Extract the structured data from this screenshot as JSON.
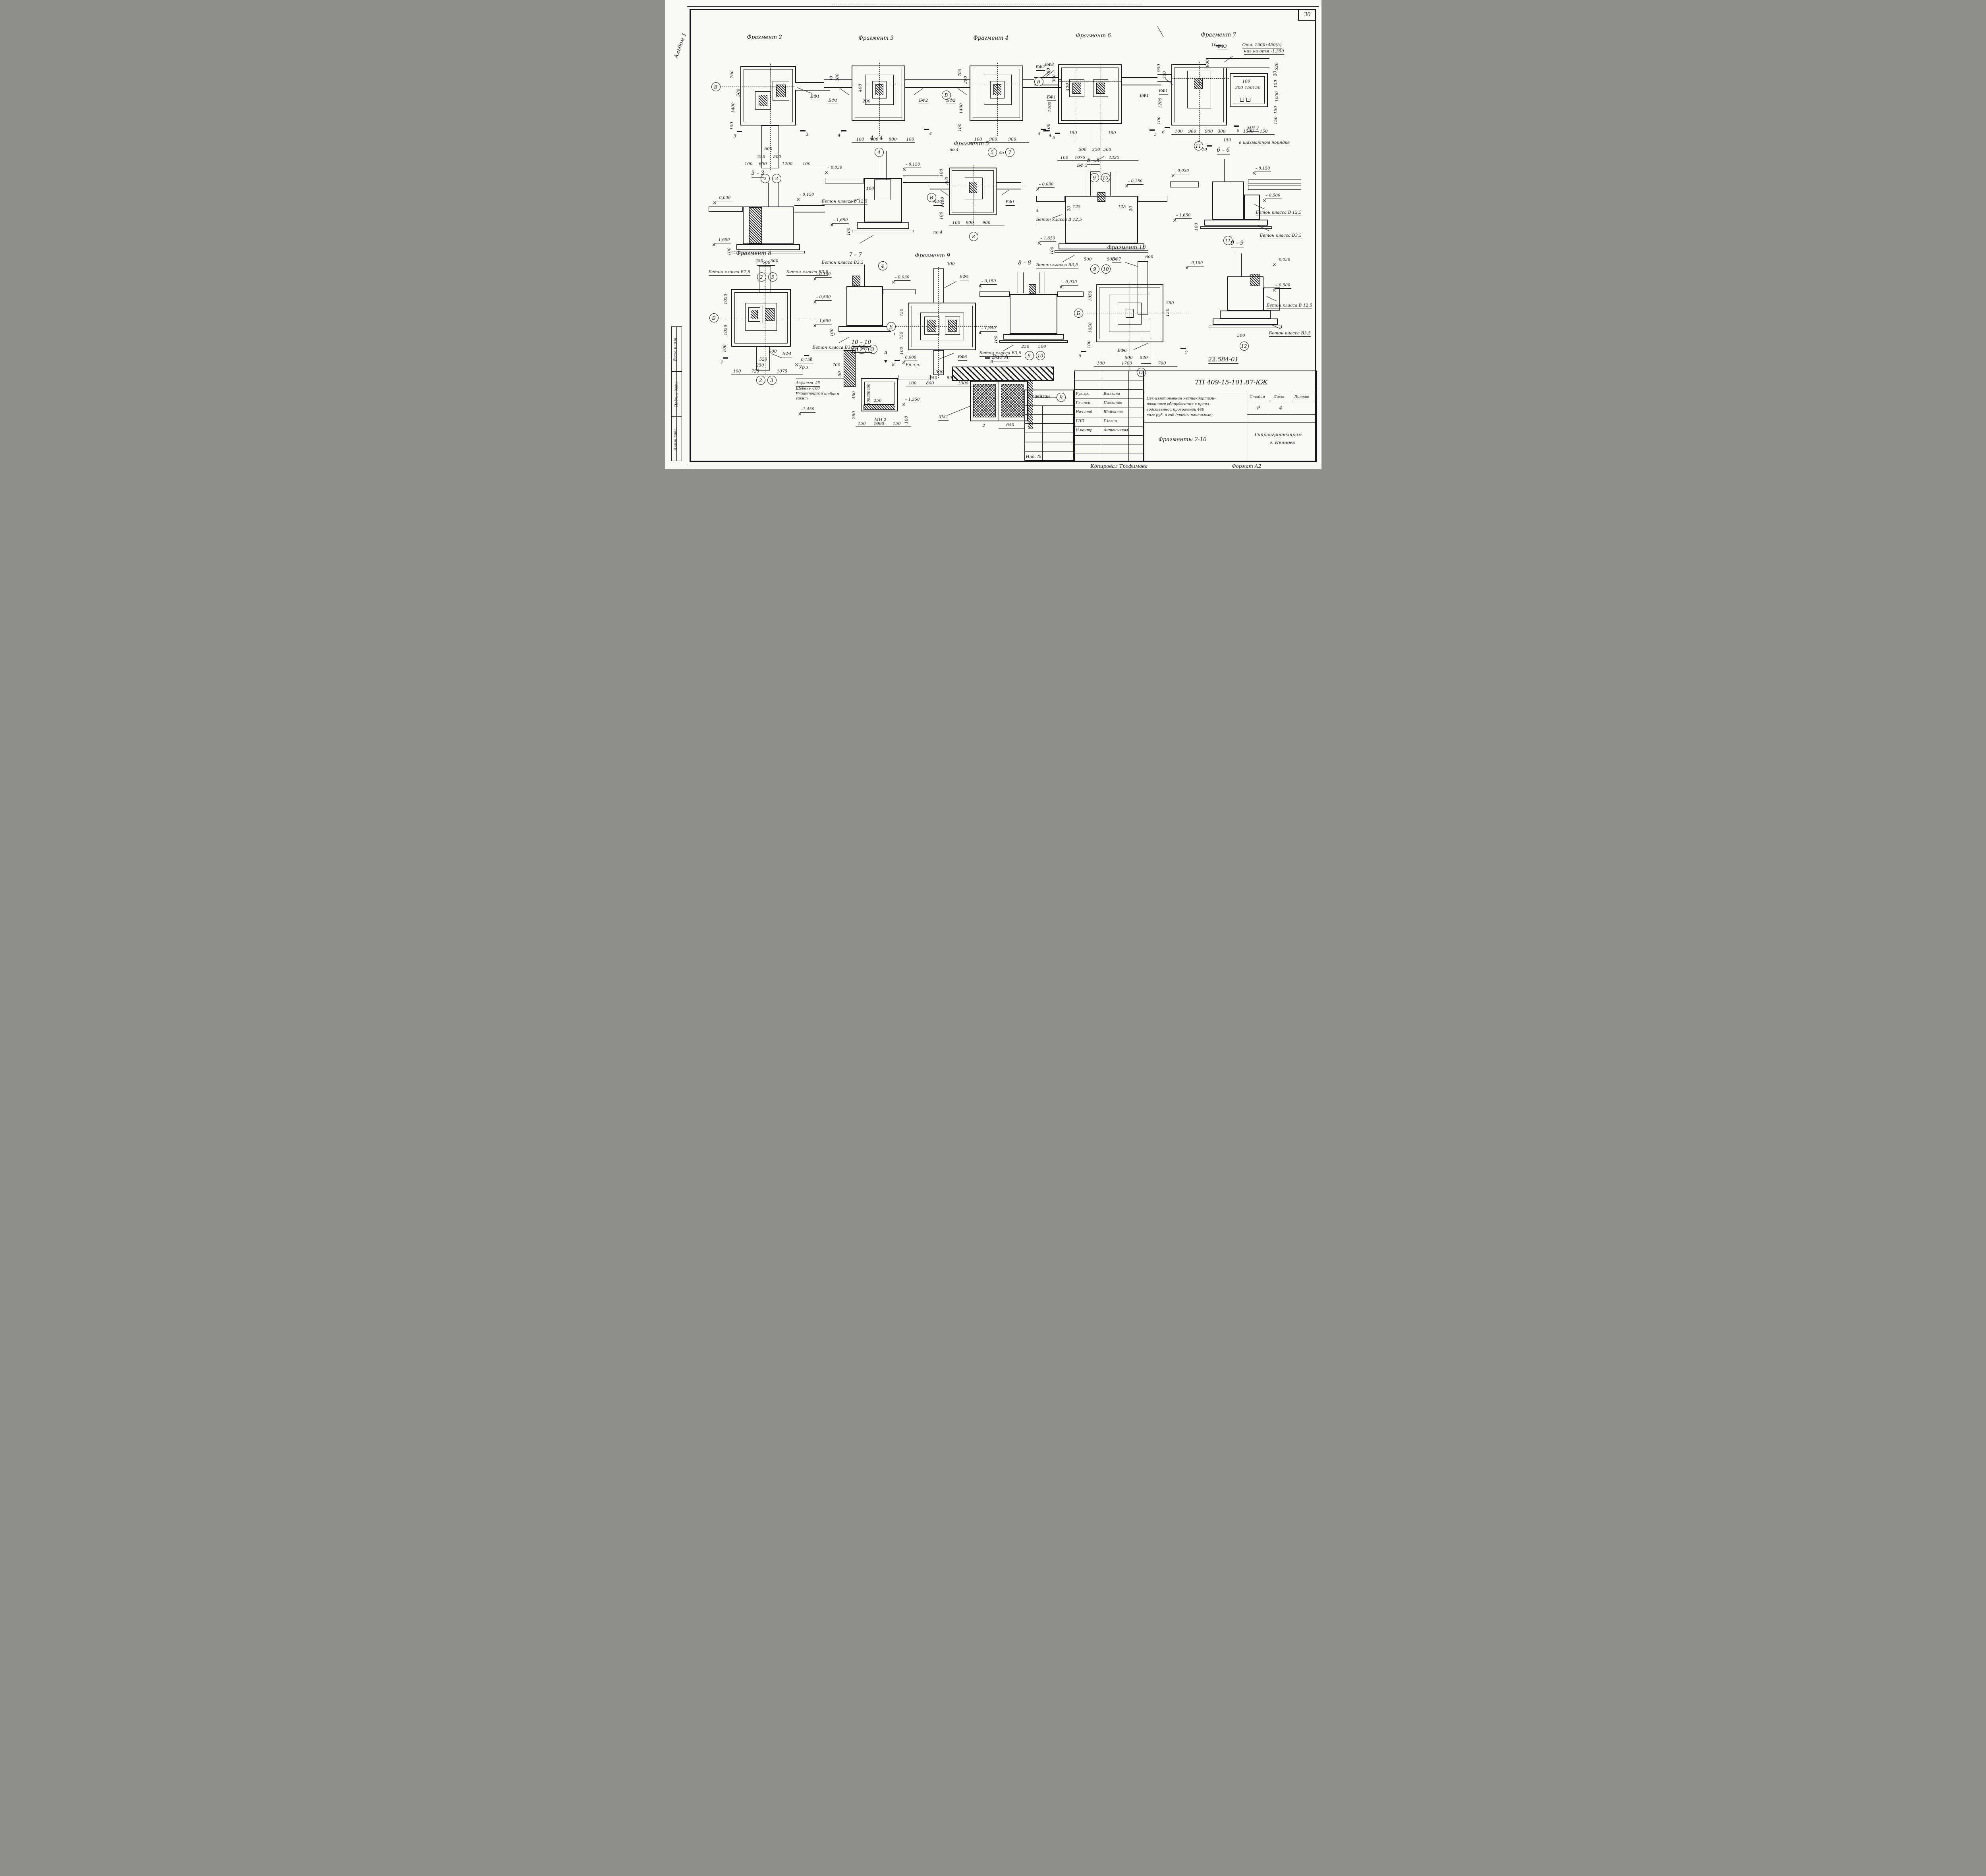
{
  "page": {
    "sheet_number": "30",
    "album_label": "Альбом 1",
    "side_stamp": [
      "Взам. инв.№",
      "Подп. и дата",
      "Инв.№ подл."
    ],
    "doc_number_note": "22.584-01",
    "copied_by": "Копировал Трофимова",
    "format_label": "Формат А2"
  },
  "title_block": {
    "type_code": "ТП 409-15-101.87-КЖ",
    "attached_label": "Привязан",
    "inv_label": "Инв. №",
    "signatures": [
      {
        "role": "Рук.гр.",
        "name": "Вылгина"
      },
      {
        "role": "Гл.спец",
        "name": "Павлинов"
      },
      {
        "role": "Нач.отд.",
        "name": "Шайхалов"
      },
      {
        "role": "ГИП",
        "name": "Глезин"
      },
      {
        "role": "Н.контр.",
        "name": "Антонычева"
      }
    ],
    "project_lines": [
      "Цех изготовления нестандартизи-",
      "рованного оборудования с произ-",
      "водственной программой 440",
      "тыс.руб. в год (стены панельные)"
    ],
    "stage_label": "Стадия",
    "sheet_label": "Лист",
    "sheets_label": "Листов",
    "stage_value": "Р",
    "sheet_value": "4",
    "sheet_title": "Фрагменты 2-10",
    "organization": "Гипроагротехпром",
    "organization_city": "г. Иваново"
  },
  "drawings": {
    "frag2": {
      "title": "Фрагмент 2",
      "grid_row": "В",
      "grid_col_1": "2",
      "grid_col_2": "3",
      "element_1": "БФ1",
      "cut": "3",
      "dim_l1": "700",
      "dim_l2": "500",
      "dim_l3": "1400",
      "dim_l4": "100",
      "dim_r1": "300",
      "dim_b1": "600",
      "dim_b2": "250",
      "dim_b3": "500",
      "dim_b4": "100",
      "dim_b5": "600",
      "dim_b6": "1200",
      "dim_b7": "100"
    },
    "frag3": {
      "title": "Фрагмент 3",
      "grid_row": "В",
      "grid_col_1": "4",
      "element_1": "БФ1",
      "element_2": "БФ2",
      "cut": "4",
      "dim_1": "300",
      "dim_2": "400",
      "dim_3": "200",
      "dim_b1": "100",
      "dim_b2": "900",
      "dim_b3": "900",
      "dim_b4": "100"
    },
    "frag4": {
      "title": "Фрагмент 4",
      "grid_row": "В",
      "grid_col_1": "5",
      "grid_between": "до",
      "grid_col_2": "7",
      "element_1": "БФ2",
      "element_2": "БФ2",
      "cut_left": "по 4",
      "cut_right": "4",
      "dim_l1": "700",
      "dim_l2": "300",
      "dim_l3": "1400",
      "dim_l4": "100",
      "dim_b1": "100",
      "dim_b2": "900",
      "dim_b3": "900"
    },
    "frag6": {
      "title": "Фрагмент 6",
      "grid_row": "В",
      "grid_col_1": "9",
      "grid_col_2": "10",
      "element_1": "БФ2",
      "element_2": "БФ1",
      "element_3": "БФ1",
      "element_4": "БФ 5",
      "cut_1": "4",
      "cut_2": "5",
      "cut_3": "5",
      "dim_l1": "700",
      "dim_l2": "300",
      "dim_l3": "1400",
      "dim_l4": "100",
      "dim_i1": "400",
      "dim_i2": "150",
      "dim_i3": "150",
      "dim_m1": "500",
      "dim_m2": "250",
      "dim_m3": "500",
      "dim_b1": "100",
      "dim_b2": "1075",
      "dim_b3": "1325"
    },
    "frag7": {
      "title": "Фрагмент 7",
      "grid_col_1": "11",
      "cut_top": "10",
      "cut_bottom": "10",
      "cut_left": "6",
      "cut_mid": "6",
      "element_1": "БФ3",
      "element_2": "БФ1",
      "note_hole_1": "Отв. 1500х450(h)",
      "note_hole_2": "низ на отм.-1,350",
      "note_mn_1": "МН 2",
      "note_mn_2": "в шахматном порядке",
      "dim_l1": "900",
      "dim_l2": "300",
      "dim_l3": "1200",
      "dim_l4": "100",
      "dim_top": "600",
      "dim_r1": "520",
      "dim_r2": "20",
      "dim_r3": "150",
      "dim_r4": "1000",
      "dim_r5": "150",
      "dim_r6": "150",
      "dim_i1": "100",
      "dim_i2": "300",
      "dim_i3": "150",
      "dim_i4": "150",
      "dim_b1": "100",
      "dim_b2": "900",
      "dim_b3": "900",
      "dim_b4": "300",
      "dim_b5": "150",
      "dim_b6": "1500",
      "dim_b7": "150"
    },
    "s33": {
      "title": "3 – 3",
      "elev_1": "– 0,030",
      "elev_2": "– 0,150",
      "elev_3": "– 1,650",
      "dim_v": "100",
      "dim_b1": "250",
      "dim_b2": "500",
      "mat_1": "Бетон класса В7,5",
      "mat_2": "Бетон класса В3,5",
      "grid_col_1": "2",
      "grid_col_2": "3"
    },
    "s44": {
      "title": "4 – 4",
      "elev_1": "– 0,030",
      "elev_2": "– 0,150",
      "elev_3": "– 1,650",
      "dim_1": "100",
      "dim_v": "100",
      "mat_1": "Бетон класса В 12,5",
      "mat_2": "Бетон класса В3,5",
      "grid_col_1": "4"
    },
    "frag5": {
      "title": "Фрагмент 5",
      "grid_row": "В",
      "grid_col_1": "8",
      "element_1": "БФ2",
      "element_2": "БФ1",
      "cut_left": "по 4",
      "dim_l1": "100",
      "dim_l2": "300",
      "dim_l3": "1400",
      "dim_l4": "100",
      "dim_b1": "100",
      "dim_b2": "900",
      "dim_b3": "900"
    },
    "s55": {
      "title": "5 – 5",
      "elev_1": "– 0,030",
      "elev_2": "– 0,150",
      "elev_3": "– 1,650",
      "cut": "4",
      "dim_1": "20",
      "dim_2": "125",
      "dim_3": "125",
      "dim_4": "20",
      "dim_v": "100",
      "mat_1": "Бетон класса В 12,5",
      "mat_2": "Бетон класса В3,5",
      "dim_b1": "500",
      "dim_b2": "500",
      "grid_col_1": "9",
      "grid_col_2": "10"
    },
    "s66": {
      "title": "6 – 6",
      "elev_1": "– 0,030",
      "elev_2": "– 0,150",
      "elev_3": "– 0,500",
      "elev_4": "– 1,650",
      "dim_v": "100",
      "mat_1": "Бетон класса В 12,5",
      "mat_2": "Бетон класса В3,5",
      "grid_col_1": "11"
    },
    "frag8": {
      "title": "Фрагмент 8",
      "grid_row": "Б",
      "grid_col_1": "2",
      "grid_col_2": "3",
      "element_1": "БФ4",
      "cut": "7",
      "dim_top": "600",
      "dim_l1": "1050",
      "dim_l2": "1050",
      "dim_l3": "100",
      "dim_m1": "600",
      "dim_m2": "520",
      "dim_m3": "250",
      "dim_b1": "100",
      "dim_b2": "725",
      "dim_b3": "1075"
    },
    "s77": {
      "title": "7 – 7",
      "elev_1": "– 0,150",
      "elev_2": "– 0,030",
      "elev_3": "– 0,500",
      "elev_4": "– 1,650",
      "dim_v": "100",
      "mat_1": "Бетон класса В3,5",
      "grid_col_1": "2",
      "grid_col_2": "3"
    },
    "d1010": {
      "title": "10 – 10",
      "label_mn": "МН 757-2",
      "label_view": "А",
      "elev_1": "0,000",
      "elev_1b": "Ур.ч.п.",
      "elev_2": "– 0,150",
      "elev_2b": "Ур.з.",
      "elev_3": "–1,450",
      "elev_4": "– 1,350",
      "layer_1": "Асфальт -25",
      "layer_2": "Щебень -100",
      "layer_3": "Уплотненный щебнем",
      "layer_4": "грунт",
      "label_mn2": "МН 2",
      "dim_1": "700",
      "dim_2": "50",
      "dim_v1": "450",
      "dim_v2": "250",
      "dim_iv1": "450",
      "dim_iv2": "300",
      "dim_iv3": "300",
      "dim_i1": "250",
      "dim_b1": "150",
      "dim_b2": "1000",
      "dim_b3": "150",
      "dim_b4": "100"
    },
    "frag9": {
      "title": "Фрагмент 9",
      "grid_row": "Б",
      "grid_col_1": "9",
      "grid_col_2": "10",
      "element_1": "БФ5",
      "element_2": "БФ6",
      "cut": "8",
      "dim_top": "300",
      "dim_l1": "750",
      "dim_l2": "750",
      "dim_l3": "100",
      "dim_m1": "300",
      "dim_m2": "250",
      "dim_m3": "500",
      "dim_b1": "100",
      "dim_b2": "800",
      "dim_b3": "1300"
    },
    "s88": {
      "title": "8 – 8",
      "elev_1": "– 0,150",
      "elev_2": "– 0,030",
      "elev_3": "– 1,650",
      "dim_v": "100",
      "mat_1": "Бетон класса В3,5",
      "dim_b1": "250",
      "dim_b2": "500",
      "grid_col_1": "9",
      "grid_col_2": "10"
    },
    "frag10": {
      "title": "Фрагмент 10",
      "grid_row": "Б",
      "grid_col_1": "12",
      "element_1": "БФ7",
      "element_2": "БФ6",
      "cut": "9",
      "dim_top": "600",
      "dim_l1": "1050",
      "dim_l2": "1050",
      "dim_l3": "100",
      "dim_r1": "250",
      "dim_r2": "150",
      "dim_m1": "500",
      "dim_m2": "520",
      "dim_b1": "100",
      "dim_b2": "1700",
      "dim_b3": "700"
    },
    "s99": {
      "title": "9 – 9",
      "elev_1": "– 0,150",
      "elev_2": "– 0,030",
      "elev_3": "– 0,500",
      "mat_1": "Бетон класса В 12,5",
      "mat_2": "Бетон класса В3,5",
      "dim_b1": "500",
      "grid_col_1": "12"
    },
    "vidA": {
      "title": "Вид А",
      "label_1": "ЛМ1",
      "label_2": "2",
      "dim_1": "650",
      "grid": "В"
    }
  }
}
